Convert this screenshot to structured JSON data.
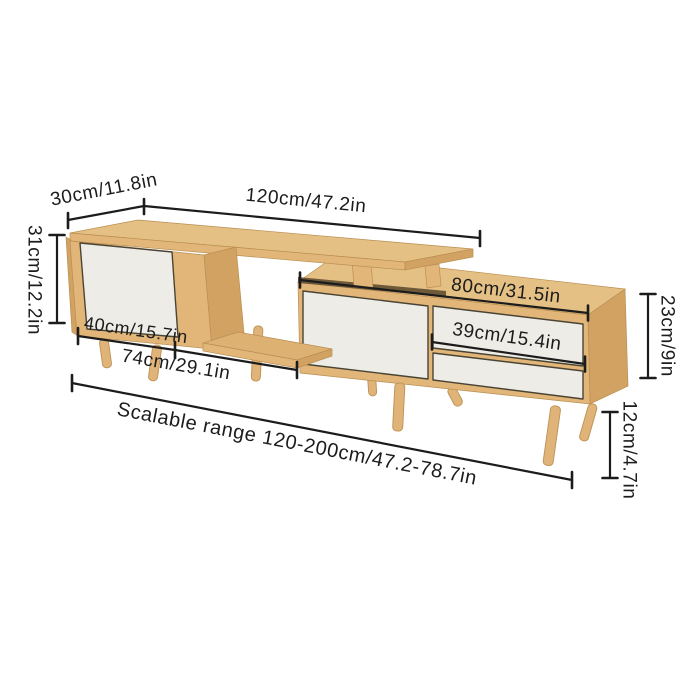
{
  "diagram": {
    "type": "product-dimension-diagram",
    "product": "scalable-tv-stand",
    "labels": {
      "depth": "30cm/11.8in",
      "width": "120cm/47.2in",
      "left_height": "31cm/12.2in",
      "cabinet_width": "40cm/15.7in",
      "shelf_width": "74cm/29.1in",
      "right_unit_width": "80cm/31.5in",
      "drawer_width": "39cm/15.4in",
      "right_unit_height": "23cm/9in",
      "leg_height": "12cm/4.7in",
      "scalable_range": "Scalable range 120-200cm/47.2-78.7in"
    },
    "colors": {
      "background": "#ffffff",
      "line": "#1c1c1c",
      "wood_top": "#e5c084",
      "wood_front": "#e2b678",
      "wood_side": "#d2a263",
      "wood_shelf": "#ddb172",
      "panel_white": "#edece6",
      "slot_shadow": "#6e5a39",
      "leg": "#e0b478"
    }
  }
}
